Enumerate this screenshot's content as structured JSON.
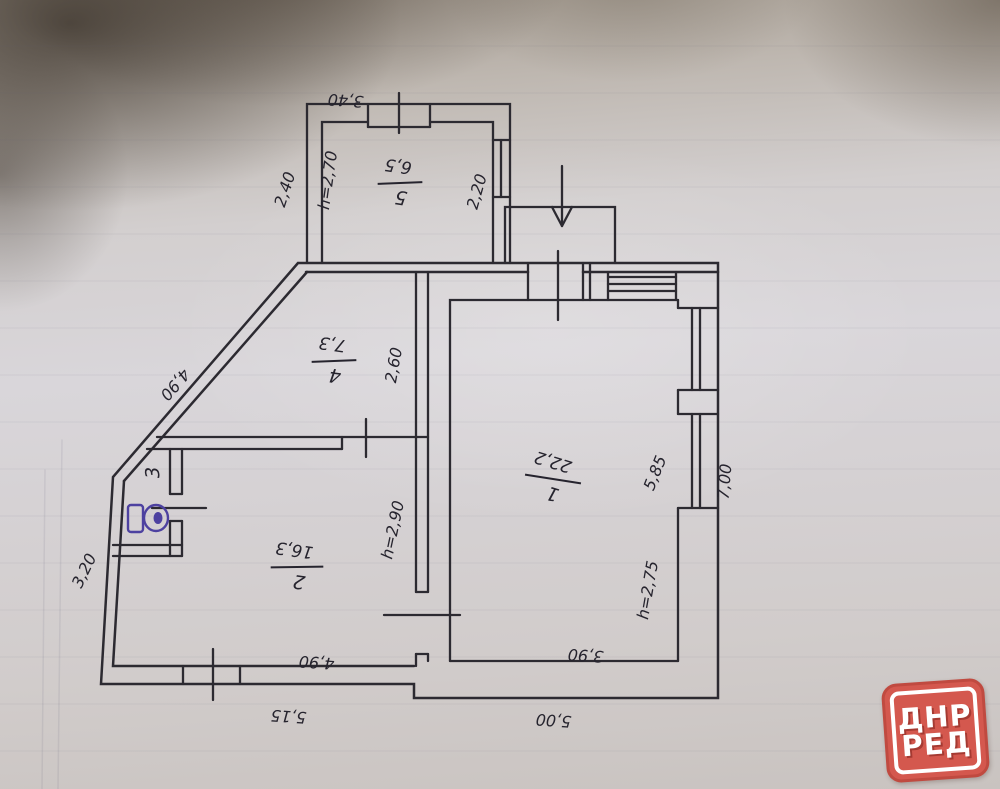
{
  "document_type": "hand-drawn floor plan photo",
  "plan": {
    "rooms": [
      {
        "number": "1",
        "area": "22,2",
        "height": "h=2,75"
      },
      {
        "number": "2",
        "area": "16,3",
        "height": "h=2,90"
      },
      {
        "number": "3"
      },
      {
        "number": "4",
        "area": "7,3"
      },
      {
        "number": "5",
        "area": "6,5",
        "height": "h=2,70"
      }
    ],
    "dimensions": {
      "room5_top": "3,40",
      "room5_left": "2,40",
      "room5_right": "2,20",
      "diagonal_wall": "4,90",
      "left_wall": "3,20",
      "hall_width": "2,60",
      "room1_right": "5,85",
      "right_wall": "7,00",
      "room2_bottom": "4,90",
      "bottom_left": "5,15",
      "room1_bottom": "3,90",
      "bottom_right": "5,00"
    },
    "icons": {
      "toilet": "toilet-bowl-symbol",
      "entrance": "arrow-down"
    },
    "ink_color": "#2c2a31",
    "toilet_ink_color": "#4d41a0"
  },
  "watermark": {
    "line1": "ДНР",
    "line2": "РЕД",
    "bg_color": "#d4584e",
    "text_color": "#ffffff"
  }
}
